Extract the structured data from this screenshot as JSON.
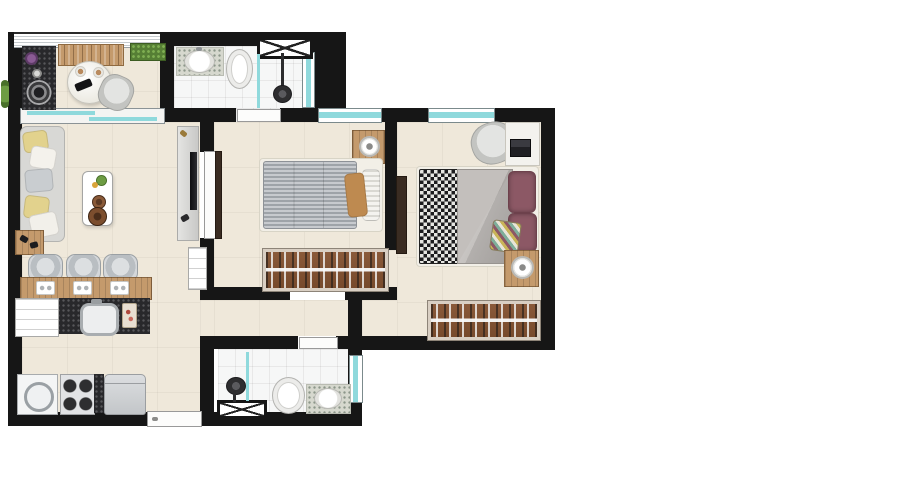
{
  "meta": {
    "category": "architectural-floor-plan",
    "description": "top-down rendered floor plan of a 2-bedroom apartment, no visible text labels",
    "visible_text": []
  },
  "palette": {
    "wall": "#161616",
    "floor-beige": "#EFE8DA",
    "floor-bath": "#F6F7F7",
    "glass": "#8FD9DC",
    "wood": "#C49A6C",
    "wood-dark": "#8A5A3A",
    "granite-dark": "#28282B",
    "granite-light": "#D6D8CE",
    "sofa-gray": "#D8D8D5",
    "pillow-yellow": "#E2D28D",
    "pillow-tan": "#BE8A50",
    "duvet-gray": "#B7B2AE",
    "pillow-maroon": "#8C5865",
    "plant-green": "#5F8F3F",
    "door-dark": "#3A2C22"
  },
  "rooms": [
    {
      "id": "balcony",
      "furniture": [
        "granite-grill-counter",
        "barbecue-grill",
        "potted-plant",
        "deck-bench",
        "round-table",
        "chair",
        "planter-box"
      ]
    },
    {
      "id": "living-room",
      "furniture": [
        "sofa",
        "throw-pillows",
        "coffee-table",
        "serving-trays",
        "tv-panel",
        "tv",
        "wood-mat"
      ]
    },
    {
      "id": "kitchen",
      "furniture": [
        "breakfast-bar",
        "bar-stool-1",
        "bar-stool-2",
        "bar-stool-3",
        "place-settings",
        "granite-counter",
        "sink",
        "cutting-board",
        "dishwasher",
        "washing-machine",
        "stove",
        "refrigerator",
        "utility-cabinet"
      ]
    },
    {
      "id": "bathroom-1",
      "furniture": [
        "sink-counter",
        "toilet",
        "shower-head",
        "glass-partition",
        "hatched-window"
      ]
    },
    {
      "id": "bedroom-1",
      "furniture": [
        "single-bed",
        "striped-duvet",
        "pillows",
        "nightstand",
        "lamp",
        "wardrobe",
        "sliding-door"
      ]
    },
    {
      "id": "bedroom-2",
      "furniture": [
        "double-bed",
        "patterned-blanket",
        "gray-duvet",
        "maroon-pillows",
        "patterned-cushion",
        "desk",
        "office-chair",
        "laptop",
        "nightstand",
        "lamp",
        "wardrobe",
        "door"
      ]
    },
    {
      "id": "bathroom-2",
      "furniture": [
        "shower-head",
        "glass-partition",
        "hatched-window",
        "toilet",
        "sink-counter"
      ]
    },
    {
      "id": "hall",
      "furniture": []
    }
  ],
  "openings": {
    "exterior_windows": 5,
    "balcony_sliding_door": 1,
    "entry_door": 1,
    "interior_doors": 4
  }
}
